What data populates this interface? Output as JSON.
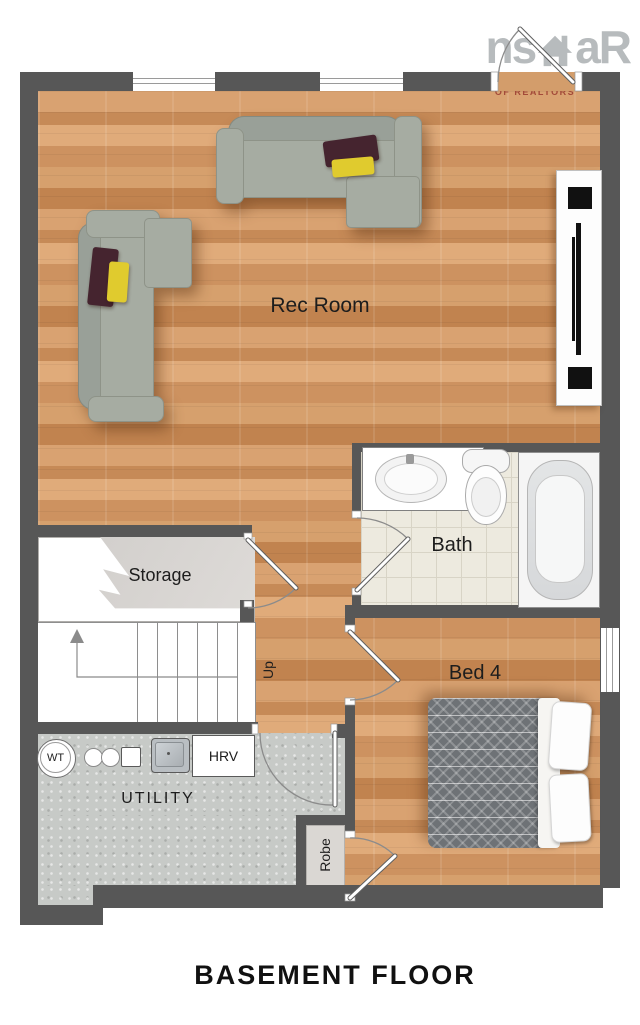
{
  "title": "BASEMENT FLOOR",
  "logo": {
    "prefix": "ns",
    "suffix": "aR",
    "line1": "NOVA SCOTIA ASSOCIATION",
    "line2": "OF REALTORS"
  },
  "rooms": {
    "rec_room": {
      "label": "Rec Room"
    },
    "storage": {
      "label": "Storage"
    },
    "bath": {
      "label": "Bath"
    },
    "bed4": {
      "label": "Bed 4"
    },
    "utility": {
      "label": "UTILITY"
    },
    "robe": {
      "label": "Robe"
    }
  },
  "stairs": {
    "direction_label": "Up"
  },
  "equipment": {
    "water_tank_label": "WT",
    "hrv_label": "HRV"
  },
  "colors": {
    "wall": "#575757",
    "wood_floor": "#d09a67",
    "bath_tile": "#edeadf",
    "concrete": "#c7cac7",
    "pillow_maroon": "#45242f",
    "pillow_yellow": "#e0cb2e",
    "logo_gray": "#b7bbbd",
    "logo_red": "#a34a39"
  }
}
